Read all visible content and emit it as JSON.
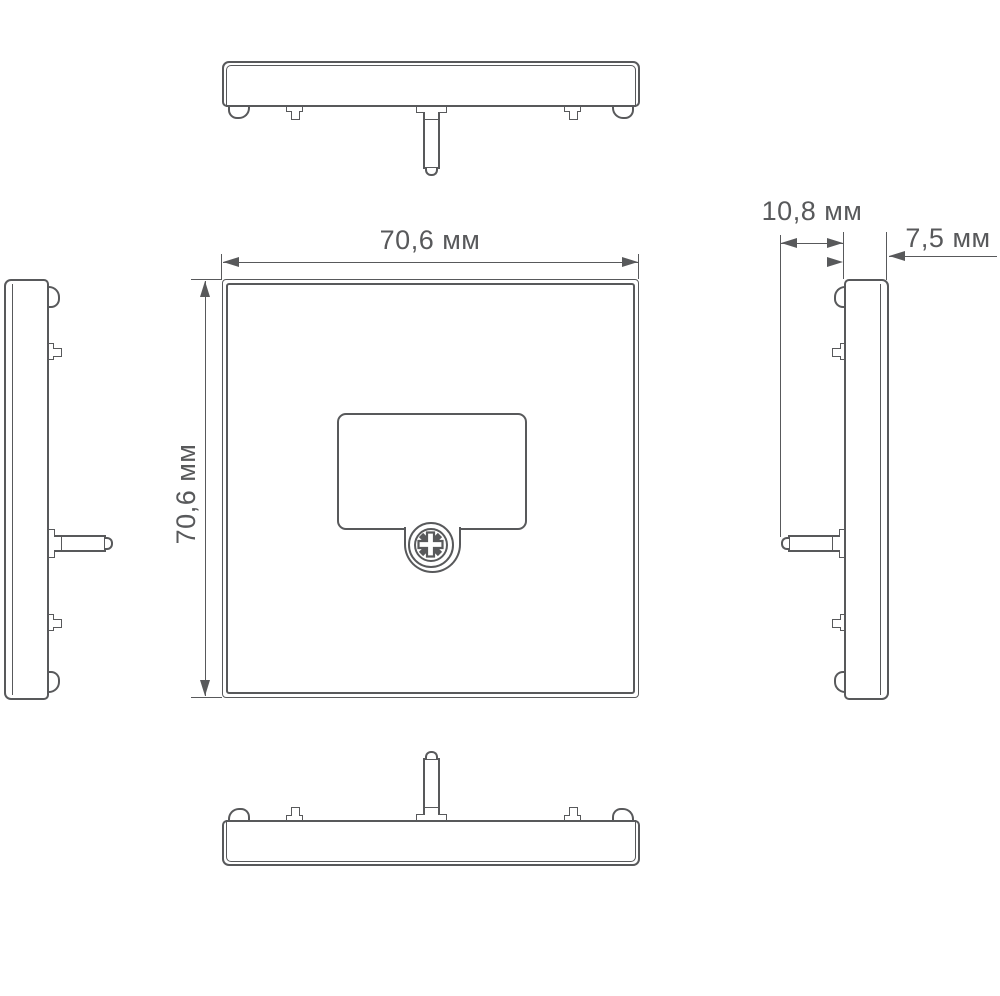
{
  "drawing": {
    "type": "technical-orthographic-views",
    "background": "#ffffff",
    "line_color": "#58595b",
    "units": "мм",
    "labels": {
      "front_width": "70,6 мм",
      "front_height": "70,6 мм",
      "pin_depth": "10,8 мм",
      "body_thickness": "7,5 мм"
    },
    "views": {
      "top": "top-profile-view",
      "front": "front-view",
      "left": "left-profile-view",
      "right": "right-profile-view",
      "bottom": "bottom-profile-view"
    },
    "dimension_values": {
      "front_width_mm": 70.6,
      "front_height_mm": 70.6,
      "pin_depth_mm": 10.8,
      "body_thickness_mm": 7.5
    }
  }
}
